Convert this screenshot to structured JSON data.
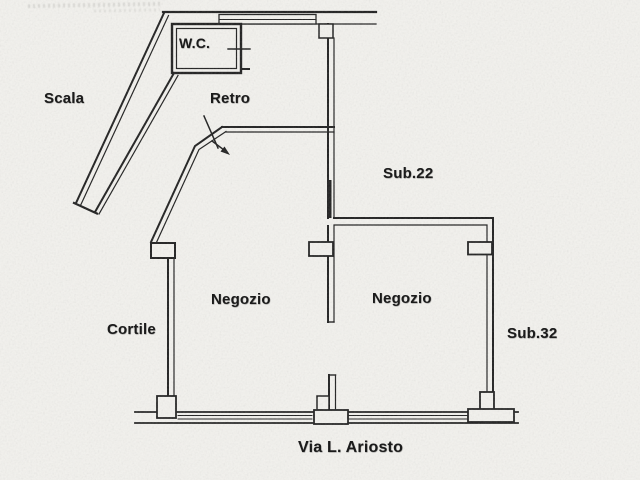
{
  "plan": {
    "street": "Via L. Ariosto",
    "rooms": {
      "wc": "W.C.",
      "scala": "Scala",
      "retro": "Retro",
      "sub22": "Sub.22",
      "negozio_left": "Negozio",
      "negozio_right": "Negozio",
      "cortile": "Cortile",
      "sub32": "Sub.32"
    }
  },
  "colors": {
    "ink": "#1e1e1e",
    "paper": "#f3f2ee"
  }
}
